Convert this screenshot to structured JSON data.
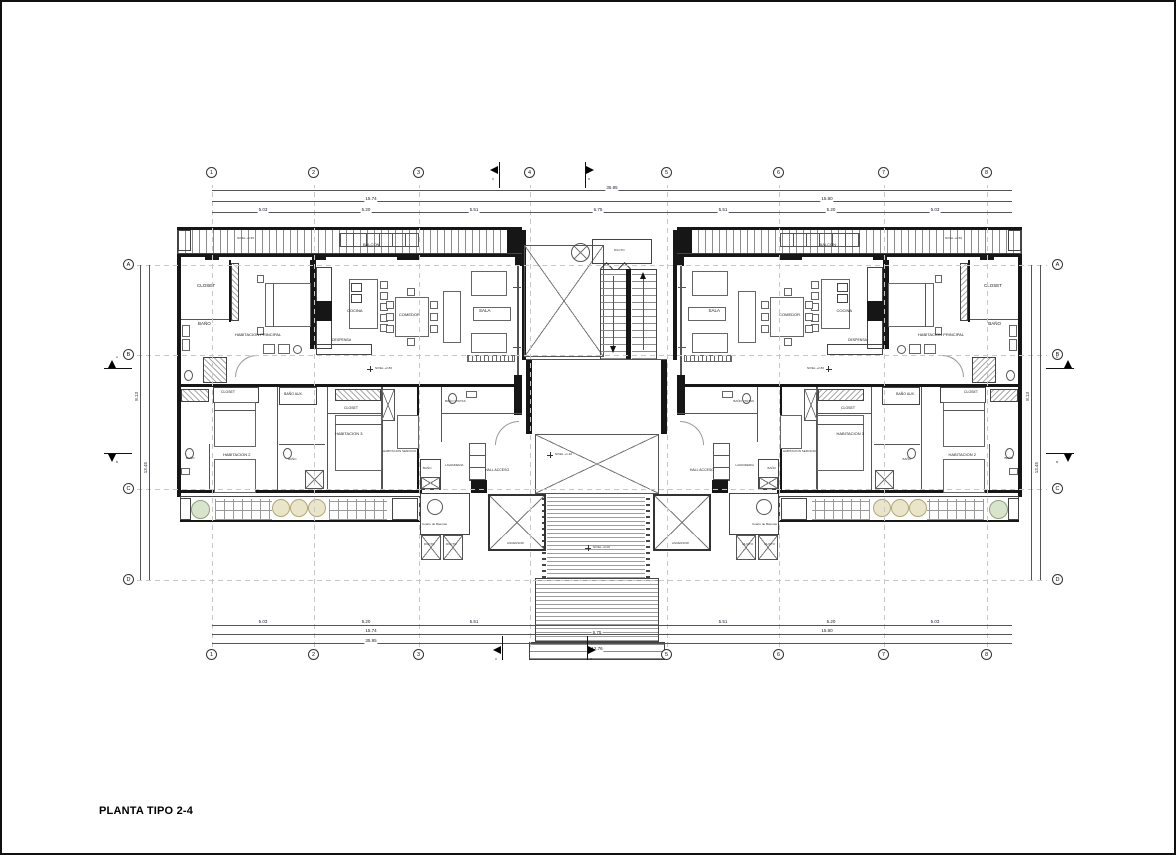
{
  "title": "PLANTA TIPO 2-4",
  "grid": {
    "top": [
      "1",
      "2",
      "3",
      "4",
      "5",
      "6",
      "7",
      "8"
    ],
    "bottom": [
      "1",
      "2",
      "3",
      "5",
      "6",
      "7",
      "8"
    ],
    "left": [
      "A",
      "B",
      "C",
      "D"
    ],
    "right": [
      "A",
      "B",
      "C",
      "D"
    ]
  },
  "dims": {
    "top_total": "35.95",
    "top_left_half": "15.74",
    "top_right_half": "15.80",
    "top_segments": [
      "5.03",
      "5.20",
      "5.51",
      "6.75",
      "5.51",
      "5.20",
      "5.03"
    ],
    "bottom_segments": [
      "5.03",
      "5.20",
      "5.51",
      "6.75",
      "5.51",
      "5.20",
      "5.03"
    ],
    "bottom_left_half": "15.74",
    "bottom_right_half": "15.80",
    "bottom_total": "35.95",
    "entry_width": "6.75",
    "entry_total": "12.76",
    "left_v": [
      "8.13",
      "13.45"
    ],
    "right_v": [
      "8.13",
      "13.45"
    ]
  },
  "sections": {
    "a": "A",
    "b": "B",
    "c": "C",
    "d": "D"
  },
  "levels": {
    "balcony": "NIVEL +2.65",
    "main": "NIVEL +2.80",
    "landing": "NIVEL +1.40",
    "entry": "NIVEL +0.00"
  },
  "rooms": {
    "balcon": "BALCON",
    "closet": "CLOSET",
    "bano": "BAÑO",
    "hab_principal": "HABITACION PRINCIPAL",
    "cocina": "COCINA",
    "despensa": "DESPENSA",
    "comedor": "COMEDOR",
    "sala": "SALA",
    "bano_visitas": "BAÑO VISITAS",
    "hab2": "HABITACION 2",
    "hab3": "HABITACION 3",
    "hab_servicio": "HABITACION SERVICIO",
    "lavanderia": "LAVANDERIA",
    "hall_acceso": "HALL ACCESO",
    "cuarto_basuras": "Cuarto de Basuras",
    "ducto": "DUCTO",
    "med_bano": "BAÑO AUX.",
    "ascensor": "ASCENSOR"
  },
  "colors": {
    "line": "#555555",
    "wall": "#161616",
    "tree_green": "#d9e4cc",
    "tree_tan": "#eae4c9",
    "paper": "#ffffff"
  }
}
